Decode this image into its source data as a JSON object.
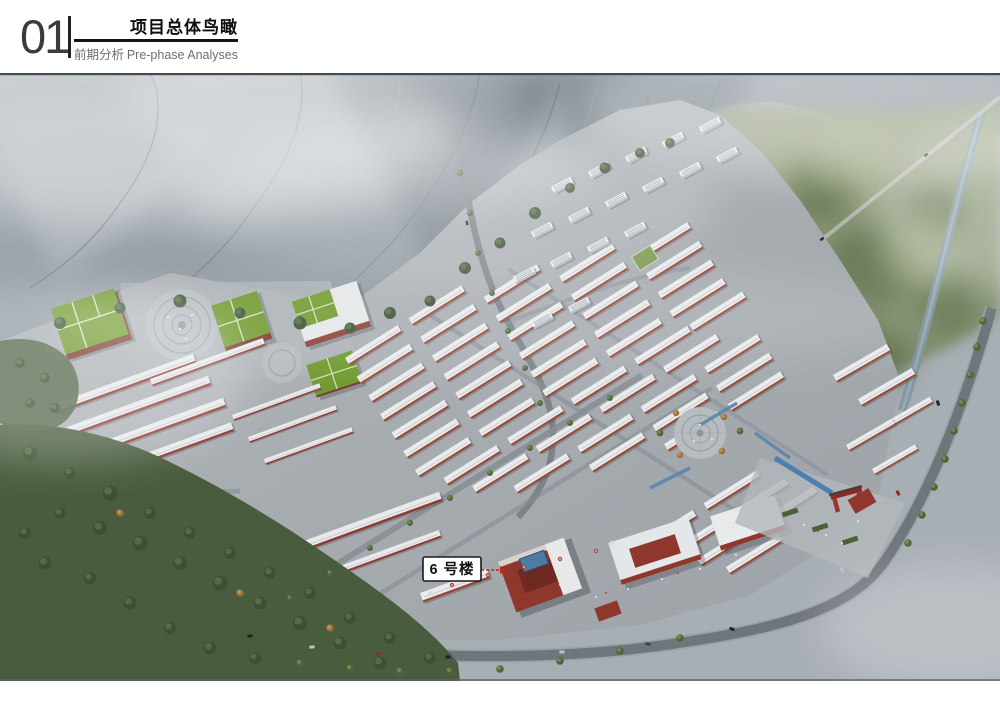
{
  "header": {
    "section_number": "01",
    "title": "项目总体鸟瞰",
    "subtitle_zh": "前期分析",
    "subtitle_en": "Pre-phase Analyses"
  },
  "annotation": {
    "building_label": "6 号楼"
  },
  "palette": {
    "header_text": "#3a3a3a",
    "header_accent": "#141414",
    "subtitle_text": "#6e6e6e",
    "image_border": "#454b51",
    "label_bg": "#ffffff",
    "label_border": "#1a1a1a",
    "label_text": "#111111",
    "arrow_red": "#c2271b",
    "green_roof": "#6f9a2c",
    "red_wall": "#8e3a32",
    "water_blue": "#4d7fae"
  }
}
